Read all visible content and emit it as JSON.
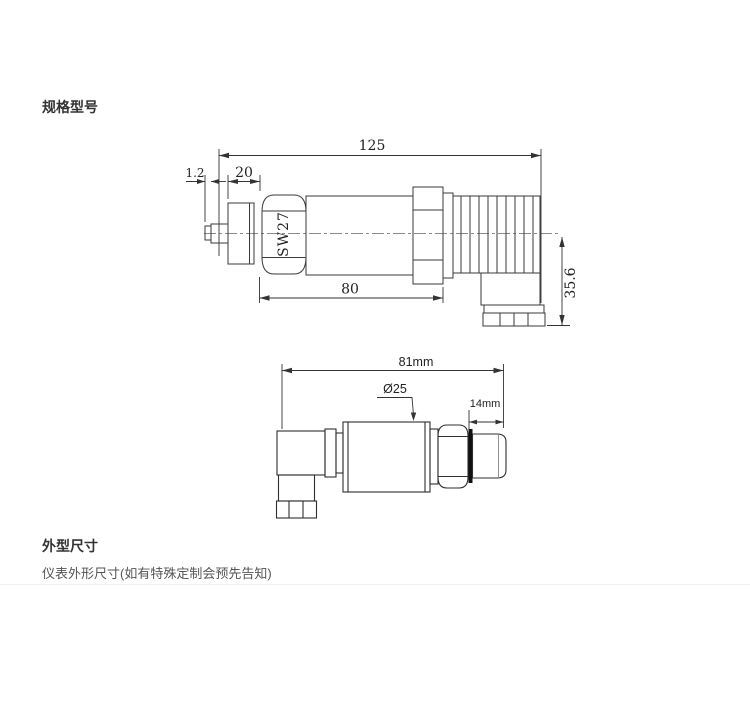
{
  "sections": {
    "spec_title": "规格型号",
    "outline_title": "外型尺寸",
    "outline_note": "仪表外形尺寸(如有特殊定制会预先告知)"
  },
  "drawing1": {
    "dim_overall": "125",
    "dim_tip": "1.2",
    "dim_port": "20",
    "dim_body": "80",
    "dim_height": "35.6",
    "hex_label": "SW27"
  },
  "drawing2": {
    "dim_overall": "81mm",
    "dim_diameter": "Ø25",
    "dim_thread": "14mm"
  }
}
